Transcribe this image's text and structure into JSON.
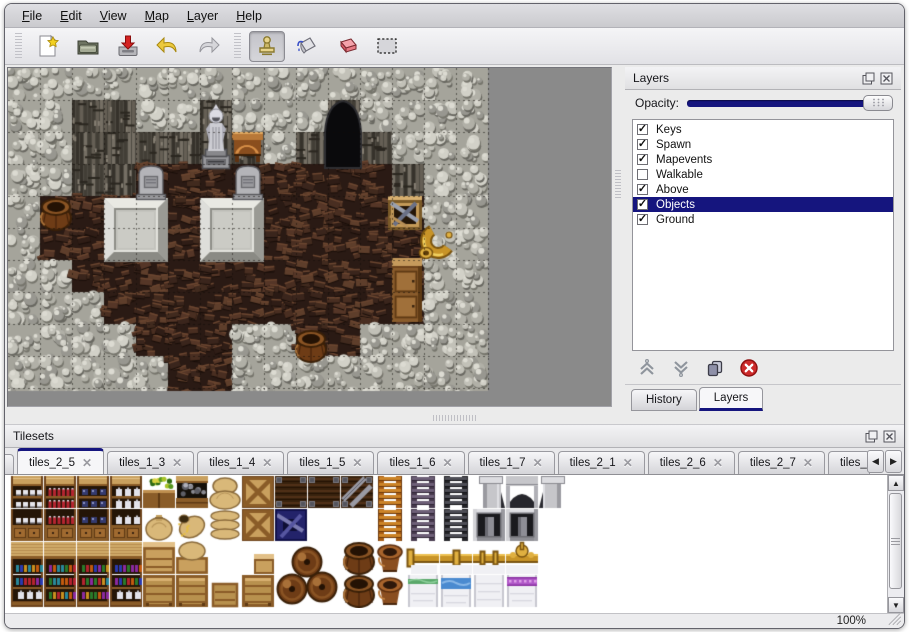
{
  "menu": {
    "items": [
      {
        "label": "File"
      },
      {
        "label": "Edit"
      },
      {
        "label": "View"
      },
      {
        "label": "Map"
      },
      {
        "label": "Layer"
      },
      {
        "label": "Help"
      }
    ]
  },
  "toolbar": {
    "icons": [
      "new-file",
      "open-folder",
      "save",
      "undo",
      "redo",
      "stamp-tool",
      "fill-tool",
      "eraser-tool",
      "select-tool"
    ],
    "active_tool": "stamp-tool"
  },
  "icons": {
    "close": "✕",
    "left_arrow": "◀",
    "right_arrow": "▶",
    "up_arrow": "▲",
    "down_arrow": "▼",
    "check": "✓"
  },
  "layers_panel": {
    "title": "Layers",
    "opacity_label": "Opacity:",
    "opacity_percent": 100,
    "items": [
      {
        "label": "Keys",
        "checked": true,
        "selected": false
      },
      {
        "label": "Spawn",
        "checked": true,
        "selected": false
      },
      {
        "label": "Mapevents",
        "checked": true,
        "selected": false
      },
      {
        "label": "Walkable",
        "checked": false,
        "selected": false
      },
      {
        "label": "Above",
        "checked": true,
        "selected": false
      },
      {
        "label": "Objects",
        "checked": true,
        "selected": true
      },
      {
        "label": "Ground",
        "checked": true,
        "selected": false
      }
    ],
    "buttons": [
      "raise-layer",
      "lower-layer",
      "duplicate-layer",
      "delete-layer"
    ],
    "tabs": [
      {
        "label": "History",
        "active": false
      },
      {
        "label": "Layers",
        "active": true
      }
    ]
  },
  "tilesets_panel": {
    "title": "Tilesets",
    "tabs": [
      {
        "label": "tiles_2_5",
        "active": true,
        "clipped": false
      },
      {
        "label": "tiles_1_3",
        "active": false,
        "clipped": false
      },
      {
        "label": "tiles_1_4",
        "active": false,
        "clipped": false
      },
      {
        "label": "tiles_1_5",
        "active": false,
        "clipped": false
      },
      {
        "label": "tiles_1_6",
        "active": false,
        "clipped": false
      },
      {
        "label": "tiles_1_7",
        "active": false,
        "clipped": false
      },
      {
        "label": "tiles_2_1",
        "active": false,
        "clipped": false
      },
      {
        "label": "tiles_2_6",
        "active": false,
        "clipped": false
      },
      {
        "label": "tiles_2_7",
        "active": false,
        "clipped": false
      },
      {
        "label": "tiles_",
        "active": false,
        "clipped": true
      }
    ]
  },
  "statusbar": {
    "zoom_level": "100%"
  },
  "colors": {
    "selection": "#15157e",
    "accent": "#15157e",
    "window_bg": "#ebebeb",
    "canvas_gray": "#8a8a8a",
    "delete_red": "#c42828"
  },
  "map": {
    "tile_size": 32,
    "grid": [
      "WWWWWWWWWWWWWWW",
      "WWDDWWDWWWCWWWW",
      "WWDDDDDDWDCDWWW",
      "WWDDFFFFFFFFDWW",
      "WFFFFFFFFFFFFWW",
      "WFFFFFFFFFFFFWW",
      "WWFFFFFFFFFFFWW",
      "WWWFFFFFFFFFFWW",
      "WWWWFFFWWFFWWWW",
      "WWWWWFFWWWWWWWW",
      "WWWWWFFWWWWWWWW"
    ],
    "objects": [
      {
        "type": "cave",
        "x": 317,
        "y": 30
      },
      {
        "type": "platform",
        "x": 96,
        "y": 130
      },
      {
        "type": "platform",
        "x": 192,
        "y": 130
      },
      {
        "type": "gravestone",
        "x": 128,
        "y": 96
      },
      {
        "type": "gravestone",
        "x": 225,
        "y": 96
      },
      {
        "type": "table",
        "x": 224,
        "y": 64
      },
      {
        "type": "statue",
        "x": 192,
        "y": 33
      },
      {
        "type": "crateBroken",
        "x": 380,
        "y": 126
      },
      {
        "type": "horn",
        "x": 411,
        "y": 158
      },
      {
        "type": "cabinet",
        "x": 384,
        "y": 190
      },
      {
        "type": "barrel",
        "x": 30,
        "y": 128
      },
      {
        "type": "barrel",
        "x": 285,
        "y": 260
      }
    ]
  },
  "tileset": {
    "pitch": 33,
    "rows": [
      [
        "shelfTopDish",
        "shelfTopRed",
        "shelfTopBlue",
        "shelfTopJar",
        "plantBox",
        "coalBox",
        "sackPile",
        "crateX",
        "darkTop",
        "darkTop",
        "darkTopDiag",
        "ladderOrange",
        "ladderGray",
        "ladderBlack",
        "archL",
        "archM",
        "archR"
      ],
      [
        "shelfBotDish",
        "shelfBotRed",
        "shelfBotBlue",
        "shelfBotJar",
        "sack",
        "sackOpen",
        "sackFlat",
        "crateX",
        "crateBlue",
        null,
        null,
        "ladderOrange",
        "ladderGray",
        "ladderBlack",
        "doorway",
        "doorway",
        null
      ],
      [
        "shelf2Top",
        "shelf2Top",
        "shelf2Top",
        "shelf2Top",
        "crateTall",
        "crateSack",
        null,
        "crateTopSmall",
        "pileTL",
        null,
        "barrel",
        "pot",
        "bedGoldEnd",
        "bedGoldMid",
        "bedGoldJoint",
        "bedGoldOrn",
        null
      ],
      [
        "shelf2Bot",
        "shelf2Bot",
        "shelf2Bot",
        "shelf2Bot",
        "crateFront",
        "crateFront",
        "crateFrontS",
        "crateFront",
        null,
        null,
        "barrel",
        "pot",
        "bedGreen",
        "bedBlue",
        "bedWhite",
        "bedPurple",
        null
      ]
    ]
  }
}
